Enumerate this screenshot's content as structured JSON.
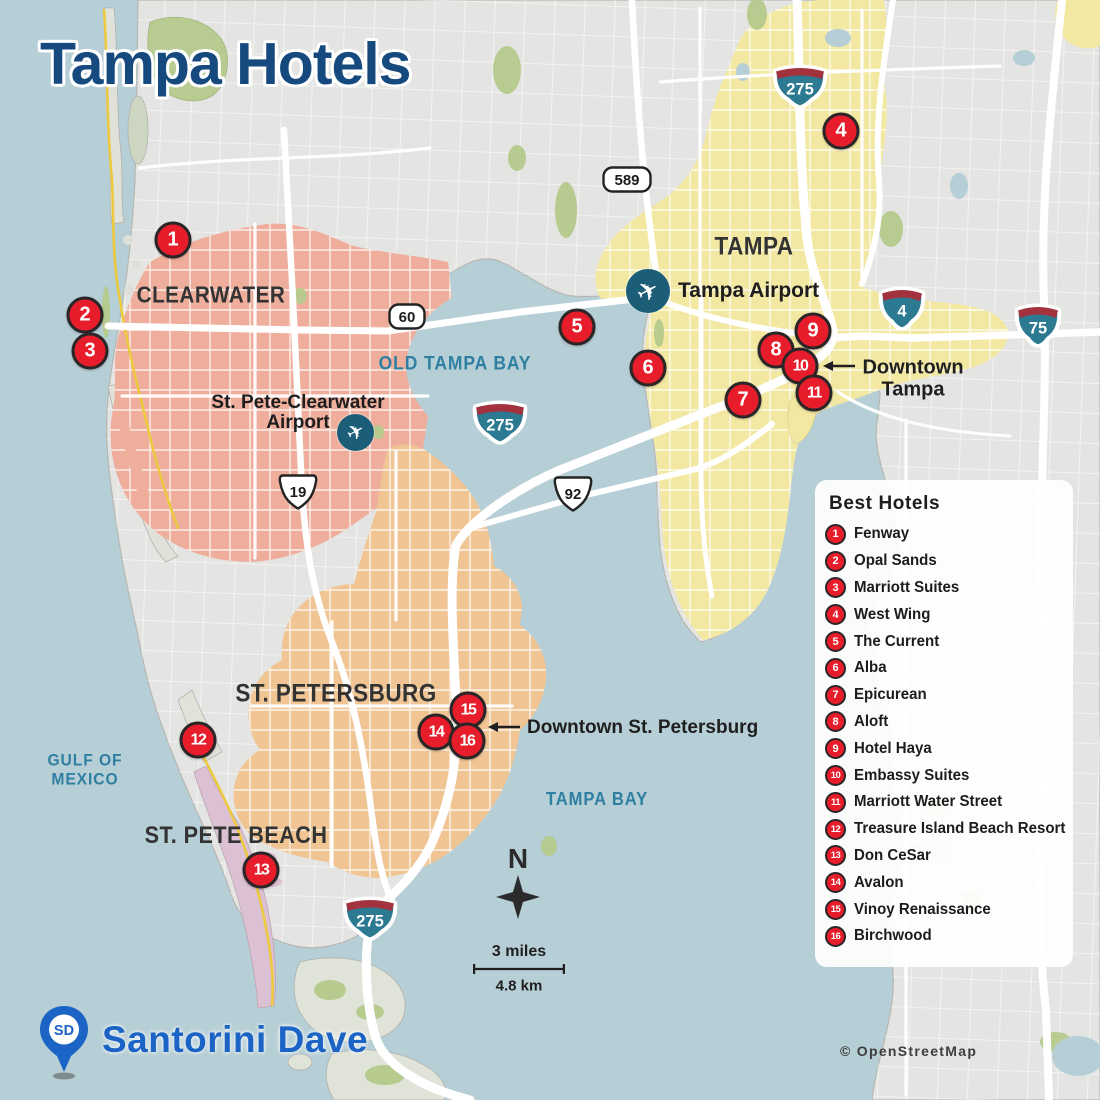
{
  "title": "Tampa Hotels",
  "attribution": "© OpenStreetMap",
  "brand": {
    "initials": "SD",
    "name": "Santorini Dave"
  },
  "compass": {
    "label": "N"
  },
  "scale": {
    "miles": "3 miles",
    "km": "4.8 km"
  },
  "colors": {
    "water": "#b6ced5",
    "land": "#e4e4e2",
    "marker_red": "#e71d2b",
    "marker_ring": "#2a2527",
    "title_blue": "#164a7f",
    "brand_blue": "#1b63c5",
    "water_label_teal": "#2f7fa2",
    "clearwater_region": "#efae9b",
    "tampa_region": "#f3e8a1",
    "st_petersburg_region": "#f0c493",
    "st_pete_beach_region": "#dcc0d3",
    "interstate_teal": "#2c7a92",
    "interstate_red": "#a2333e",
    "airport_teal": "#1c5e78"
  },
  "legend": {
    "title": "Best Hotels",
    "items": [
      {
        "n": "1",
        "label": "Fenway"
      },
      {
        "n": "2",
        "label": "Opal Sands"
      },
      {
        "n": "3",
        "label": "Marriott Suites"
      },
      {
        "n": "4",
        "label": "West Wing"
      },
      {
        "n": "5",
        "label": "The Current"
      },
      {
        "n": "6",
        "label": "Alba"
      },
      {
        "n": "7",
        "label": "Epicurean"
      },
      {
        "n": "8",
        "label": "Aloft"
      },
      {
        "n": "9",
        "label": "Hotel Haya"
      },
      {
        "n": "10",
        "label": "Embassy Suites"
      },
      {
        "n": "11",
        "label": "Marriott Water Street"
      },
      {
        "n": "12",
        "label": "Treasure Island Beach Resort"
      },
      {
        "n": "13",
        "label": "Don CeSar"
      },
      {
        "n": "14",
        "label": "Avalon"
      },
      {
        "n": "15",
        "label": "Vinoy Renaissance"
      },
      {
        "n": "16",
        "label": "Birchwood"
      }
    ]
  },
  "markers": [
    {
      "n": "1",
      "x": 173,
      "y": 240
    },
    {
      "n": "2",
      "x": 85,
      "y": 315
    },
    {
      "n": "3",
      "x": 90,
      "y": 351
    },
    {
      "n": "4",
      "x": 841,
      "y": 131
    },
    {
      "n": "5",
      "x": 577,
      "y": 327
    },
    {
      "n": "6",
      "x": 648,
      "y": 368
    },
    {
      "n": "7",
      "x": 743,
      "y": 400
    },
    {
      "n": "8",
      "x": 776,
      "y": 350
    },
    {
      "n": "9",
      "x": 813,
      "y": 331
    },
    {
      "n": "10",
      "x": 800,
      "y": 366
    },
    {
      "n": "11",
      "x": 814,
      "y": 393
    },
    {
      "n": "12",
      "x": 198,
      "y": 740
    },
    {
      "n": "13",
      "x": 261,
      "y": 870
    },
    {
      "n": "14",
      "x": 436,
      "y": 732
    },
    {
      "n": "15",
      "x": 468,
      "y": 710
    },
    {
      "n": "16",
      "x": 467,
      "y": 741
    }
  ],
  "city_labels": [
    {
      "text": "CLEARWATER",
      "x": 211,
      "y": 295,
      "size": 23
    },
    {
      "text": "TAMPA",
      "x": 754,
      "y": 247,
      "size": 25
    },
    {
      "text": "ST. PETERSBURG",
      "x": 336,
      "y": 694,
      "size": 25
    },
    {
      "text": "ST. PETE BEACH",
      "x": 236,
      "y": 836,
      "size": 24
    }
  ],
  "water_labels": [
    {
      "lines": [
        "OLD TAMPA BAY"
      ],
      "x": 455,
      "y": 365,
      "size": 19
    },
    {
      "lines": [
        "TAMPA BAY"
      ],
      "x": 597,
      "y": 800,
      "size": 18
    },
    {
      "lines": [
        "GULF OF",
        "MEXICO"
      ],
      "x": 85,
      "y": 770,
      "size": 17
    }
  ],
  "airports": {
    "tampa": {
      "label": "Tampa Airport"
    },
    "stpete_clearwater": {
      "line1": "St. Pete-Clearwater",
      "line2": "Airport"
    }
  },
  "annotations": {
    "tampa": {
      "line1": "Downtown",
      "line2": "Tampa"
    },
    "stpete": {
      "text": "Downtown St. Petersburg"
    }
  },
  "shields": [
    {
      "type": "interstate",
      "num": "275",
      "x": 800,
      "y": 88
    },
    {
      "type": "interstate",
      "num": "275",
      "x": 500,
      "y": 424
    },
    {
      "type": "interstate",
      "num": "275",
      "x": 370,
      "y": 920
    },
    {
      "type": "interstate",
      "num": "4",
      "x": 902,
      "y": 310
    },
    {
      "type": "interstate",
      "num": "75",
      "x": 1038,
      "y": 327
    },
    {
      "type": "us",
      "num": "19",
      "x": 298,
      "y": 494
    },
    {
      "type": "us",
      "num": "92",
      "x": 573,
      "y": 496
    },
    {
      "type": "state",
      "num": "60",
      "x": 407,
      "y": 319
    },
    {
      "type": "state",
      "num": "589",
      "x": 627,
      "y": 182
    }
  ]
}
